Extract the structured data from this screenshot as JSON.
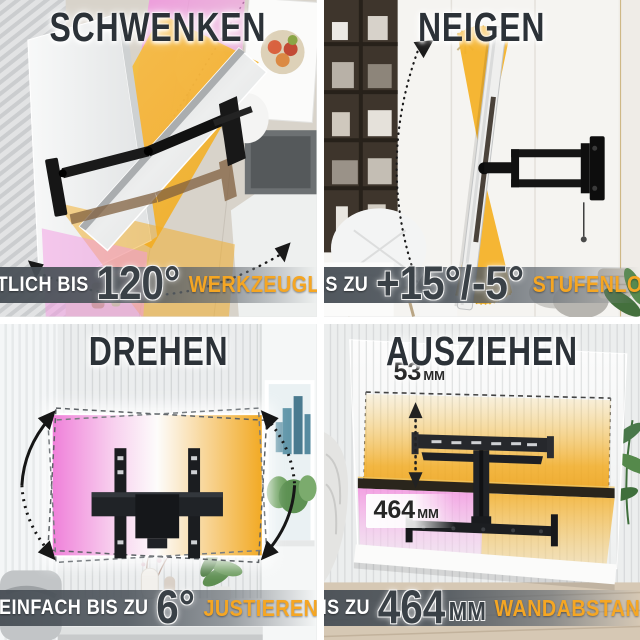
{
  "colors": {
    "keyword_text": "#f5a623",
    "title_text": "#2c3238",
    "caption_bar": "#4a5157",
    "overlay_pink": "#ef7fd9",
    "overlay_amber": "#f3ae31",
    "mount_black": "#161616"
  },
  "panels": [
    {
      "id": "schwenken",
      "title": "SCHWENKEN",
      "caption": {
        "prefix": "SEITLICH BIS",
        "value": "120°",
        "keyword": "WERKZEUGLOS"
      }
    },
    {
      "id": "neigen",
      "title": "NEIGEN",
      "caption": {
        "prefix": "BIS ZU",
        "value": "+15°/-5°",
        "keyword": "STUFENLOS"
      }
    },
    {
      "id": "drehen",
      "title": "DREHEN",
      "caption": {
        "prefix": "EINFACH BIS ZU",
        "value": "6°",
        "keyword": "JUSTIEREN"
      }
    },
    {
      "id": "ausziehen",
      "title": "AUSZIEHEN",
      "caption": {
        "prefix": "BIS ZU",
        "value": "464",
        "unit": "MM",
        "keyword": "WANDABSTAND"
      },
      "measurements": [
        {
          "value": "53",
          "unit": "MM"
        },
        {
          "value": "464",
          "unit": "MM"
        }
      ]
    }
  ]
}
